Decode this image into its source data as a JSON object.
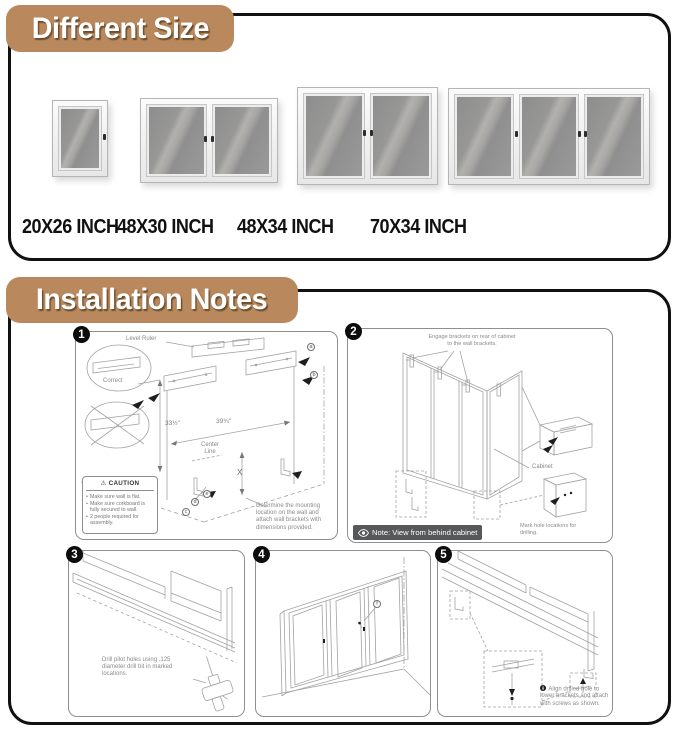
{
  "colors": {
    "banner_bg": "#b9895d",
    "panel_border": "#111111",
    "note_badge_bg": "#57585a",
    "line_art": "#a2a2a2",
    "cork_gray": "#9a9a9a"
  },
  "icons": {
    "warning": "⚠"
  },
  "different_size": {
    "title": "Different Size",
    "boards": [
      {
        "label": "20X26 INCH",
        "doors": 1
      },
      {
        "label": "48X30 INCH",
        "doors": 2
      },
      {
        "label": "48X34 INCH",
        "doors": 2
      },
      {
        "label": "70X34 INCH",
        "doors": 3
      }
    ]
  },
  "installation": {
    "title": "Installation Notes",
    "steps": [
      {
        "number": "1",
        "level_ruler": "Level Ruler",
        "correct": "Correct",
        "dim_width": "39¾\"",
        "dim_height": "33½\"",
        "center_line": "Center Line",
        "x_label": "X",
        "letters": {
          "a": "a",
          "b": "b",
          "c": "c",
          "d": "d",
          "e": "e"
        },
        "caution_title": "CAUTION",
        "caution_items": [
          "Make sure wall is flat.",
          "Make sure corkboard is fully secured to wall.",
          "2 people required for assembly."
        ],
        "note": "Determine the mounting location on the wall and attach wall brackets with dimensions provided."
      },
      {
        "number": "2",
        "engage_note": "Engage brackets on rear of cabinet to the wall brackets.",
        "cabinet_label": "Cabinet",
        "mark_holes_note": "Mark hole locations for drilling.",
        "view_note": "Note: View from behind cabinet"
      },
      {
        "number": "3",
        "drill_note": "Drill pilot holes using .125 diameter drill bit in marked locations."
      },
      {
        "number": "4",
        "screw_letter": "f"
      },
      {
        "number": "5",
        "align_letter": "g",
        "align_note": "Align drilled hole to lower brackets and attach with screws as shown."
      }
    ]
  }
}
